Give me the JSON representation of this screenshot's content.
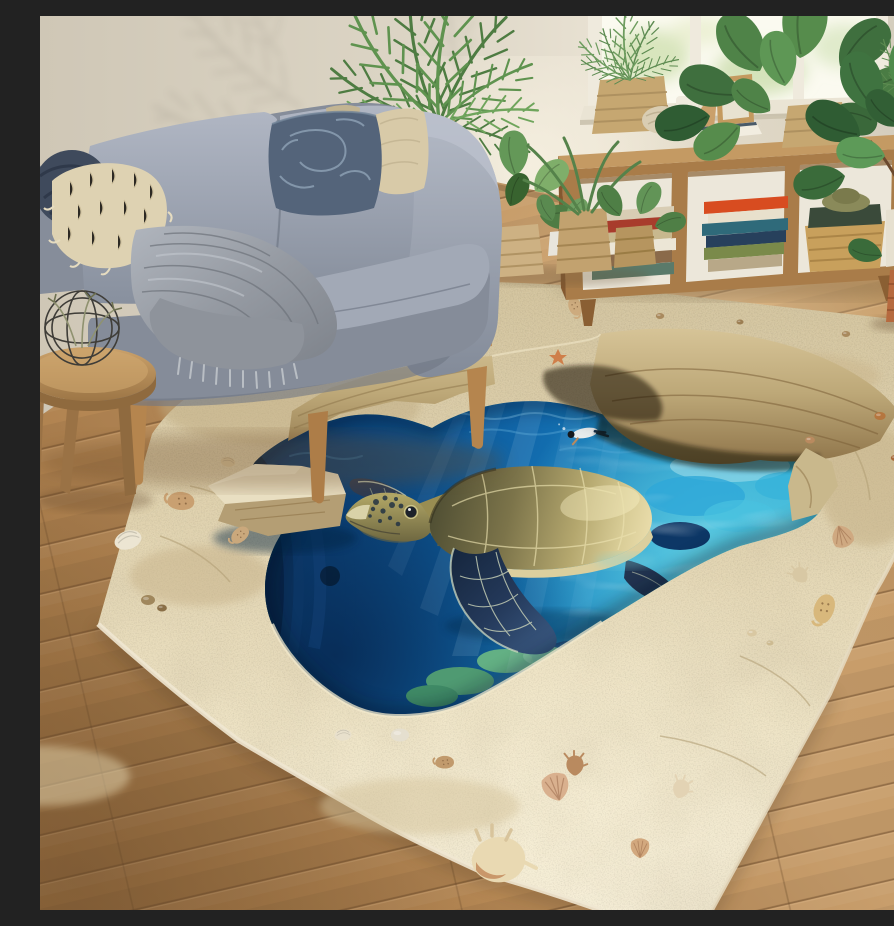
{
  "scene": {
    "type": "photograph",
    "title": "3D ocean sinkhole rug with sea turtle in a living room",
    "description": "Bright living room with a gray sofa, wooden bookshelf under a window, potted plants, wooden floor, and a large 3D-effect rug that looks like a sandy sinkhole opening into deep blue ocean water with a swimming sea turtle, divers and coral reef."
  },
  "palette": {
    "wall": "#d8d1c2",
    "wall_shadow": "#b4ab9a",
    "window_light": "#fbfaf0",
    "window_frame": "#efeadd",
    "baseboard": "#efeade",
    "floor_light": "#cfa878",
    "floor_mid": "#b58755",
    "floor_dark": "#8f6a3f",
    "shelf_wood": "#a97c49",
    "shelf_wood_dark": "#84582f",
    "shelf_interior": "#ece7da",
    "sofa_fabric": "#98a0ad",
    "sofa_fabric_light": "#b2b8c4",
    "sofa_fabric_dark": "#747c8a",
    "sofa_wood": "#c0915a",
    "pillow_dark": "#54647a",
    "pillow_beige": "#d8caa8",
    "pillow_shag": "#ded2b2",
    "pillow_navy": "#3f4a5c",
    "throw_gray": "#9aa0a8",
    "stool_wood": "#b9915c",
    "plant_green": "#568347",
    "plant_green_dark": "#38632f",
    "plant_green_light": "#74a565",
    "basket_tan": "#c6a771",
    "pot_terracotta": "#b66a3f",
    "sand_light": "#efe6cb",
    "sand_mid": "#d9cba8",
    "sand_shadow": "#b39e74",
    "rock_tan": "#d2bf93",
    "rock_shadow": "#8f7448",
    "water_deep": "#0a3b72",
    "water_mid": "#1470b4",
    "water_azure": "#2fa9d4",
    "water_turquoise": "#53cfe2",
    "water_pale": "#bce8dc",
    "reef_dark": "#0d3766",
    "reef_green": "#4f9a72",
    "turtle_shell_dark": "#57563a",
    "turtle_shell_light": "#e4d9a4",
    "turtle_skin": "#b3a763",
    "turtle_flipper": "#1d2f49",
    "turtle_pattern": "#cdd6ba",
    "shell_white": "#ece5d2",
    "shell_tan": "#c9a071",
    "diver_dark": "#1c3850"
  },
  "objects": [
    {
      "name": "wall",
      "label": "Warm beige wall with palm leaf shadows"
    },
    {
      "name": "window",
      "label": "Bright window with white frame and garden light"
    },
    {
      "name": "bookshelf",
      "label": "Low wooden bookshelf with books, baskets and plants"
    },
    {
      "name": "sofa",
      "label": "Gray fabric sofa with cushions, pillows and throw blanket"
    },
    {
      "name": "palm-plant",
      "label": "Areca palm behind the sofa"
    },
    {
      "name": "floor",
      "label": "Warm oak plank wooden floor"
    },
    {
      "name": "rug",
      "label": "3D sandy sinkhole rug with seashells"
    },
    {
      "name": "ocean-hole",
      "label": "Deep blue ocean opening with coral reef and light rays"
    },
    {
      "name": "sea-turtle",
      "label": "Green sea turtle swimming above the reef"
    },
    {
      "name": "divers",
      "label": "Tiny snorkelers swimming in the water"
    },
    {
      "name": "stool",
      "label": "Round wooden stool with wire decor sphere"
    },
    {
      "name": "fiddle-plant",
      "label": "Fiddle leaf fig in terracotta pot"
    },
    {
      "name": "floor-plants",
      "label": "Potted plants in woven baskets beside sofa"
    },
    {
      "name": "seashells",
      "label": "Seashells and pebbles scattered on the sand"
    }
  ]
}
